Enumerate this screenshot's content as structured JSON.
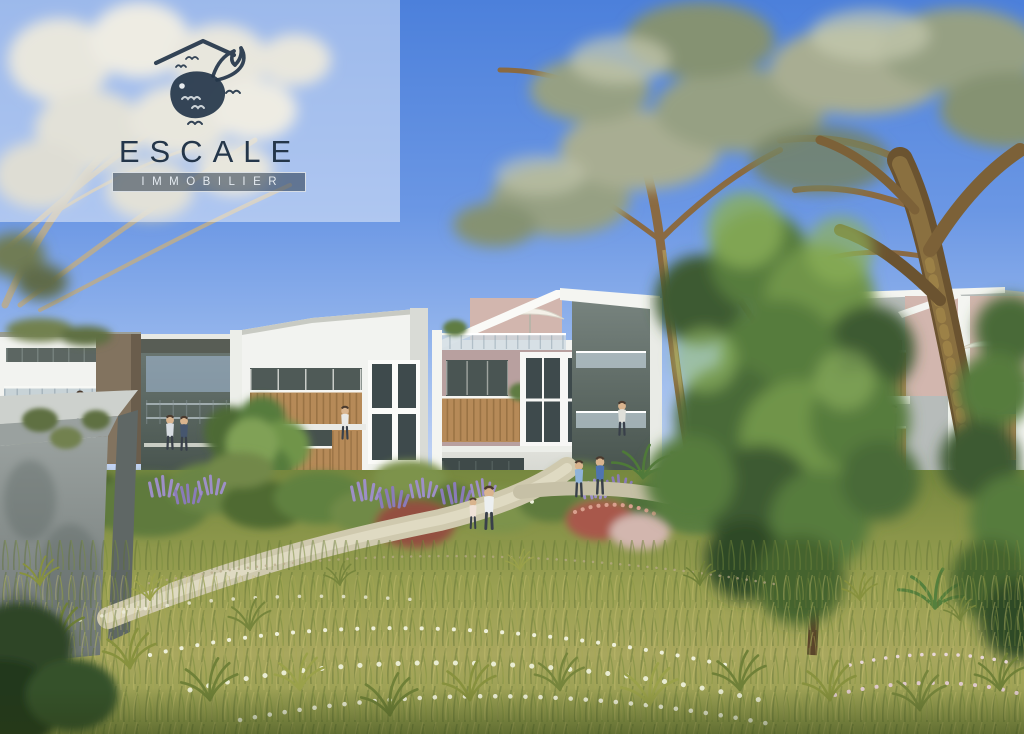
{
  "logo": {
    "title": "ESCALE",
    "subtitle": "IMMOBILIER",
    "icon": "whale-house-logo-icon"
  },
  "scene_type": "architectural-render-residences",
  "colors": {
    "sky-top": "#4c80db",
    "sky-mid": "#7fa5e6",
    "sky-horizon": "#c3d4f4",
    "sky-cloud": "#ffffff",
    "overlay-white": "rgba(255,255,255,0.45)",
    "logo-ink": "#24364a",
    "logo-box-bg": "rgba(36,52,71,0.55)",
    "logo-box-border": "rgba(235,240,244,0.85)",
    "logo-text-light": "#e4eaf0",
    "building-white": "#f2f3f0",
    "building-shadow": "#d9dbd6",
    "window-dark": "#3e4a4c",
    "balcony-wood": "#b68a58",
    "facade-mauve": "#b8a09f",
    "facade-pink": "#d2b6ae",
    "concrete-gray": "#8e9594",
    "tree-sage": "#96a083",
    "tree-pale": "#d6d3c2",
    "tree-green": "#567b3c",
    "trunk-brown": "#7c6138",
    "meadow-green": "#8a9a4e",
    "grass-light": "#c7c06e",
    "path-sand": "#cfc9ae",
    "lavender": "#9d8fc6",
    "flower-white": "#eef0da",
    "shrub-pink": "#bd7a6c"
  }
}
